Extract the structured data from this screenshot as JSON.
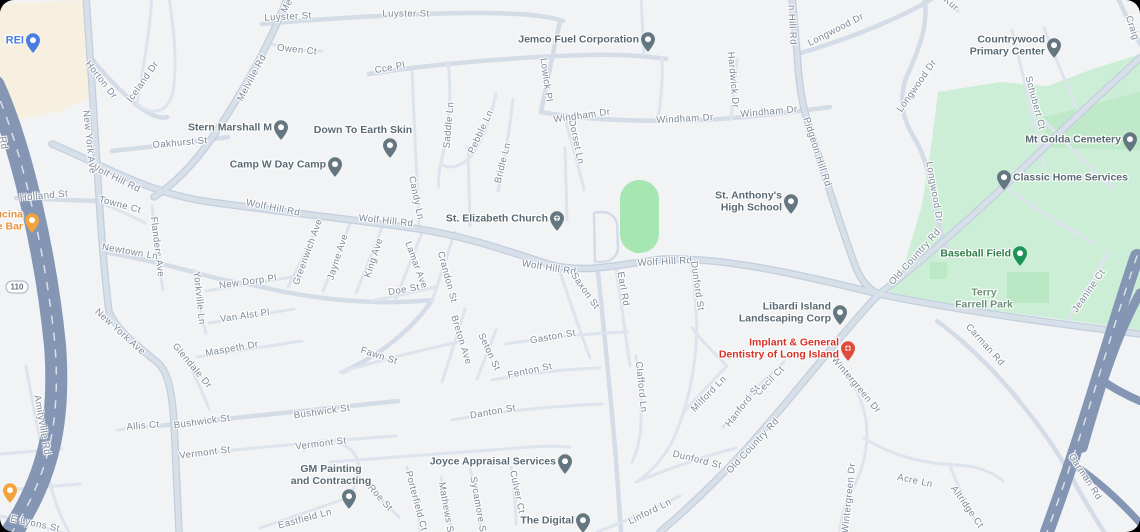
{
  "colors": {
    "background": "#f2f3f5",
    "road_minor": "#dde4ed",
    "road_medium": "#d4dce7",
    "road_major": "#d7dfe9",
    "highway": "#8496b3",
    "park": "#cdeed6",
    "park_dark": "#b9e6c3",
    "field_green": "#a5e6b2",
    "beige": "#f7f0e0",
    "road_label": "#7d8897",
    "poi_label": "#5a6a74"
  },
  "shields": [
    {
      "text": "110",
      "x": 17,
      "y": 287
    }
  ],
  "road_labels": [
    {
      "text": "Luyster St",
      "x": 288,
      "y": 17,
      "rot": -3
    },
    {
      "text": "Luyster St",
      "x": 406,
      "y": 14,
      "rot": 0
    },
    {
      "text": "Me",
      "x": 287,
      "y": 6,
      "rot": -62
    },
    {
      "text": "Owen Ct",
      "x": 297,
      "y": 50,
      "rot": 6
    },
    {
      "text": "Horton Dr",
      "x": 101,
      "y": 80,
      "rot": 52
    },
    {
      "text": "Iceland Dr",
      "x": 143,
      "y": 82,
      "rot": -55
    },
    {
      "text": "Melville Rd",
      "x": 252,
      "y": 78,
      "rot": -62
    },
    {
      "text": "Oakhurst St",
      "x": 180,
      "y": 143,
      "rot": -5
    },
    {
      "text": "Cce Pl",
      "x": 390,
      "y": 68,
      "rot": -10
    },
    {
      "text": "Saddle Ln",
      "x": 449,
      "y": 125,
      "rot": -85
    },
    {
      "text": "Pebble Ln",
      "x": 481,
      "y": 132,
      "rot": -65
    },
    {
      "text": "Bridle Ln",
      "x": 503,
      "y": 163,
      "rot": -76
    },
    {
      "text": "Lowick Pl",
      "x": 546,
      "y": 80,
      "rot": 82
    },
    {
      "text": "Dorset Ln",
      "x": 576,
      "y": 142,
      "rot": 78
    },
    {
      "text": "Windham Dr",
      "x": 582,
      "y": 116,
      "rot": -8
    },
    {
      "text": "Windham Dr",
      "x": 685,
      "y": 119,
      "rot": -3
    },
    {
      "text": "Windham Dr",
      "x": 769,
      "y": 112,
      "rot": -5
    },
    {
      "text": "Hardwick Dr",
      "x": 733,
      "y": 80,
      "rot": 85
    },
    {
      "text": "n Hill Rd",
      "x": 792,
      "y": 25,
      "rot": 87
    },
    {
      "text": "Pidgeon Hill Rd",
      "x": 817,
      "y": 152,
      "rot": 72
    },
    {
      "text": "Longwood Dr",
      "x": 836,
      "y": 30,
      "rot": -27
    },
    {
      "text": "Longwood Dr",
      "x": 917,
      "y": 86,
      "rot": -55
    },
    {
      "text": "Longwood Dr",
      "x": 934,
      "y": 192,
      "rot": 80
    },
    {
      "text": "Kur",
      "x": 951,
      "y": 4,
      "rot": 42
    },
    {
      "text": "Craig",
      "x": 1132,
      "y": 28,
      "rot": 72
    },
    {
      "text": "Schubert Ct",
      "x": 1035,
      "y": 103,
      "rot": 75
    },
    {
      "text": "Wolf Hill Rd",
      "x": 115,
      "y": 178,
      "rot": 26
    },
    {
      "text": "Wolf Hill Rd",
      "x": 273,
      "y": 208,
      "rot": 11
    },
    {
      "text": "Wolf Hill Rd",
      "x": 386,
      "y": 221,
      "rot": 6
    },
    {
      "text": "Wolf Hill Rd",
      "x": 549,
      "y": 268,
      "rot": 9
    },
    {
      "text": "Wolf Hill Rd",
      "x": 665,
      "y": 262,
      "rot": -3
    },
    {
      "text": "Holland St",
      "x": 44,
      "y": 196,
      "rot": -5
    },
    {
      "text": "Towne Ct",
      "x": 120,
      "y": 205,
      "rot": 15
    },
    {
      "text": "Flanders Ave",
      "x": 157,
      "y": 247,
      "rot": 83
    },
    {
      "text": "New York Ave",
      "x": 89,
      "y": 142,
      "rot": 84
    },
    {
      "text": "New York Ave",
      "x": 120,
      "y": 332,
      "rot": 42
    },
    {
      "text": "Newtown Ln",
      "x": 130,
      "y": 252,
      "rot": 10
    },
    {
      "text": "Yorkville Ln",
      "x": 199,
      "y": 298,
      "rot": 84
    },
    {
      "text": "New Dorp Pl",
      "x": 248,
      "y": 282,
      "rot": -8
    },
    {
      "text": "Van Alst Pl",
      "x": 245,
      "y": 316,
      "rot": -8
    },
    {
      "text": "Greenwich Ave",
      "x": 308,
      "y": 252,
      "rot": -70
    },
    {
      "text": "Jayne Ave",
      "x": 338,
      "y": 257,
      "rot": -72
    },
    {
      "text": "King Ave",
      "x": 374,
      "y": 258,
      "rot": -72
    },
    {
      "text": "Lamar Ave",
      "x": 416,
      "y": 265,
      "rot": 70
    },
    {
      "text": "Candy Ln",
      "x": 416,
      "y": 198,
      "rot": 78
    },
    {
      "text": "Doe St",
      "x": 404,
      "y": 290,
      "rot": -10
    },
    {
      "text": "Crandon St",
      "x": 447,
      "y": 277,
      "rot": 75
    },
    {
      "text": "Maspeth Dr",
      "x": 232,
      "y": 349,
      "rot": -10
    },
    {
      "text": "Glendale Dr",
      "x": 192,
      "y": 366,
      "rot": 50
    },
    {
      "text": "Bushwick St",
      "x": 202,
      "y": 422,
      "rot": -8
    },
    {
      "text": "Bushwick St",
      "x": 322,
      "y": 412,
      "rot": -8
    },
    {
      "text": "Allis Ct",
      "x": 143,
      "y": 426,
      "rot": -5
    },
    {
      "text": "Vermont St",
      "x": 205,
      "y": 453,
      "rot": -7
    },
    {
      "text": "Vermont St",
      "x": 321,
      "y": 444,
      "rot": -7
    },
    {
      "text": "Amityville Rd",
      "x": 42,
      "y": 425,
      "rot": 80
    },
    {
      "text": "E Lyons St",
      "x": 35,
      "y": 524,
      "rot": 12
    },
    {
      "text": "Fawn St",
      "x": 379,
      "y": 356,
      "rot": 18
    },
    {
      "text": "Breton Ave",
      "x": 461,
      "y": 340,
      "rot": 73
    },
    {
      "text": "Seton St",
      "x": 489,
      "y": 352,
      "rot": 65
    },
    {
      "text": "Gaston St",
      "x": 553,
      "y": 337,
      "rot": -10
    },
    {
      "text": "Fenton St",
      "x": 530,
      "y": 371,
      "rot": -12
    },
    {
      "text": "Danton St",
      "x": 493,
      "y": 412,
      "rot": -10
    },
    {
      "text": "Saxon St",
      "x": 585,
      "y": 291,
      "rot": 55
    },
    {
      "text": "Earl Rd",
      "x": 623,
      "y": 289,
      "rot": 80
    },
    {
      "text": "Dunford St",
      "x": 697,
      "y": 286,
      "rot": 82
    },
    {
      "text": "Clafford Ln",
      "x": 641,
      "y": 387,
      "rot": 84
    },
    {
      "text": "Milford Ln",
      "x": 709,
      "y": 394,
      "rot": -46
    },
    {
      "text": "Dunford St",
      "x": 697,
      "y": 460,
      "rot": 14
    },
    {
      "text": "Linford Ln",
      "x": 650,
      "y": 512,
      "rot": -26
    },
    {
      "text": "Culver Ct",
      "x": 517,
      "y": 492,
      "rot": 78
    },
    {
      "text": "Sycamore St",
      "x": 478,
      "y": 506,
      "rot": 80
    },
    {
      "text": "Mathews St",
      "x": 446,
      "y": 509,
      "rot": 80
    },
    {
      "text": "Porterfield Ct",
      "x": 416,
      "y": 501,
      "rot": 75
    },
    {
      "text": "Roe St",
      "x": 380,
      "y": 498,
      "rot": 48
    },
    {
      "text": "Eastfield Ln",
      "x": 305,
      "y": 519,
      "rot": -15
    },
    {
      "text": "Old Country Rd",
      "x": 915,
      "y": 257,
      "rot": -48
    },
    {
      "text": "Old Country Rd",
      "x": 753,
      "y": 446,
      "rot": -47
    },
    {
      "text": "Cecil Ct",
      "x": 770,
      "y": 381,
      "rot": -46
    },
    {
      "text": "Hanford St",
      "x": 743,
      "y": 406,
      "rot": -52
    },
    {
      "text": "Wintergreen Dr",
      "x": 856,
      "y": 385,
      "rot": 50
    },
    {
      "text": "Wintergreen Dr",
      "x": 849,
      "y": 498,
      "rot": -84
    },
    {
      "text": "Acre Ln",
      "x": 915,
      "y": 481,
      "rot": 12
    },
    {
      "text": "Altridge Ct",
      "x": 967,
      "y": 507,
      "rot": 55
    },
    {
      "text": "Carman Rd",
      "x": 985,
      "y": 345,
      "rot": 48
    },
    {
      "text": "Carman Rd",
      "x": 1085,
      "y": 477,
      "rot": 57
    },
    {
      "text": "Jeanine Ct",
      "x": 1089,
      "y": 291,
      "rot": -55
    },
    {
      "text": "Rd",
      "x": 3,
      "y": 143,
      "rot": 80
    }
  ],
  "pois": [
    {
      "name": "REI",
      "lines": [
        "REI"
      ],
      "x": 33,
      "y": 53,
      "pos": "left",
      "color": "#4a7de2",
      "text_color": "#4a7de2",
      "size": 11
    },
    {
      "name": "Jemco Fuel Corporation",
      "lines": [
        "Jemco Fuel Corporation"
      ],
      "x": 648,
      "y": 52,
      "pos": "left",
      "color": "#64767f",
      "text_color": "#5a6a74"
    },
    {
      "name": "Stern Marshall M",
      "lines": [
        "Stern Marshall M"
      ],
      "x": 281,
      "y": 140,
      "pos": "left",
      "color": "#64767f",
      "text_color": "#5a6a74"
    },
    {
      "name": "Down To Earth Skin",
      "lines": [
        "Down To Earth Skin"
      ],
      "x": 390,
      "y": 158,
      "pos": "above",
      "dx": -27,
      "color": "#64767f",
      "text_color": "#5a6a74"
    },
    {
      "name": "Camp W Day Camp",
      "lines": [
        "Camp W Day Camp"
      ],
      "x": 335,
      "y": 177,
      "pos": "left",
      "color": "#64767f",
      "text_color": "#5a6a74"
    },
    {
      "name": "St. Elizabeth Church",
      "lines": [
        "St. Elizabeth Church"
      ],
      "x": 557,
      "y": 231,
      "pos": "left",
      "color": "#64767f",
      "text_color": "#5a6a74",
      "glyph": "✝"
    },
    {
      "name": "St. Anthony's High School",
      "lines": [
        "St. Anthony's",
        "High School"
      ],
      "x": 791,
      "y": 214,
      "pos": "left",
      "color": "#64767f",
      "text_color": "#5a6a74"
    },
    {
      "name": "Countrywood Primary Center",
      "lines": [
        "Countrywood",
        "Primary Center"
      ],
      "x": 1054,
      "y": 58,
      "pos": "left",
      "color": "#64767f",
      "text_color": "#5a6a74"
    },
    {
      "name": "Mt Golda Cemetery",
      "lines": [
        "Mt Golda Cemetery"
      ],
      "x": 1130,
      "y": 152,
      "pos": "left",
      "color": "#64767f",
      "text_color": "#5a6a74"
    },
    {
      "name": "Classic Home Services",
      "lines": [
        "Classic Home Services"
      ],
      "x": 1004,
      "y": 190,
      "pos": "right",
      "color": "#64767f",
      "text_color": "#5a6a74"
    },
    {
      "name": "Baseball Field",
      "lines": [
        "Baseball Field"
      ],
      "x": 1020,
      "y": 266,
      "pos": "left",
      "color": "#1d9457",
      "text_color": "#2e7d46"
    },
    {
      "name": "Terry Farrell Park",
      "lines": [
        "Terry",
        "Farrell Park"
      ],
      "x": 984,
      "y": 299,
      "pos": "none",
      "pin": false,
      "text_color": "#6b8f79"
    },
    {
      "name": "Libardi Island Landscaping Corp",
      "lines": [
        "Libardi Island",
        "Landscaping Corp"
      ],
      "x": 840,
      "y": 325,
      "pos": "left",
      "color": "#64767f",
      "text_color": "#5a6a74"
    },
    {
      "name": "Implant & General Dentistry of Long Island",
      "lines": [
        "Implant & General",
        "Dentistry of Long Island"
      ],
      "x": 848,
      "y": 361,
      "pos": "left",
      "color": "#de4b3b",
      "text_color": "#d93025",
      "glyph": "✚"
    },
    {
      "name": "cucina wine bar (clipped)",
      "lines": [
        "ucina",
        "e Bar"
      ],
      "x": 32,
      "y": 233,
      "pos": "left",
      "color": "#f2a33c",
      "text_color": "#e8913a"
    },
    {
      "name": "restaurant",
      "lines": [],
      "x": 10,
      "y": 503,
      "pos": "left",
      "color": "#f2a33c",
      "text_color": "#e8913a"
    },
    {
      "name": "GM Painting and Contracting",
      "lines": [
        "GM Painting",
        "and Contracting"
      ],
      "x": 349,
      "y": 509,
      "pos": "above",
      "dx": -18,
      "color": "#64767f",
      "text_color": "#5a6a74"
    },
    {
      "name": "Joyce Appraisal Services",
      "lines": [
        "Joyce Appraisal Services"
      ],
      "x": 565,
      "y": 474,
      "pos": "left",
      "color": "#64767f",
      "text_color": "#5a6a74"
    },
    {
      "name": "The Digital",
      "lines": [
        "The Digital"
      ],
      "x": 583,
      "y": 533,
      "pos": "left",
      "color": "#64767f",
      "text_color": "#5a6a74"
    }
  ]
}
